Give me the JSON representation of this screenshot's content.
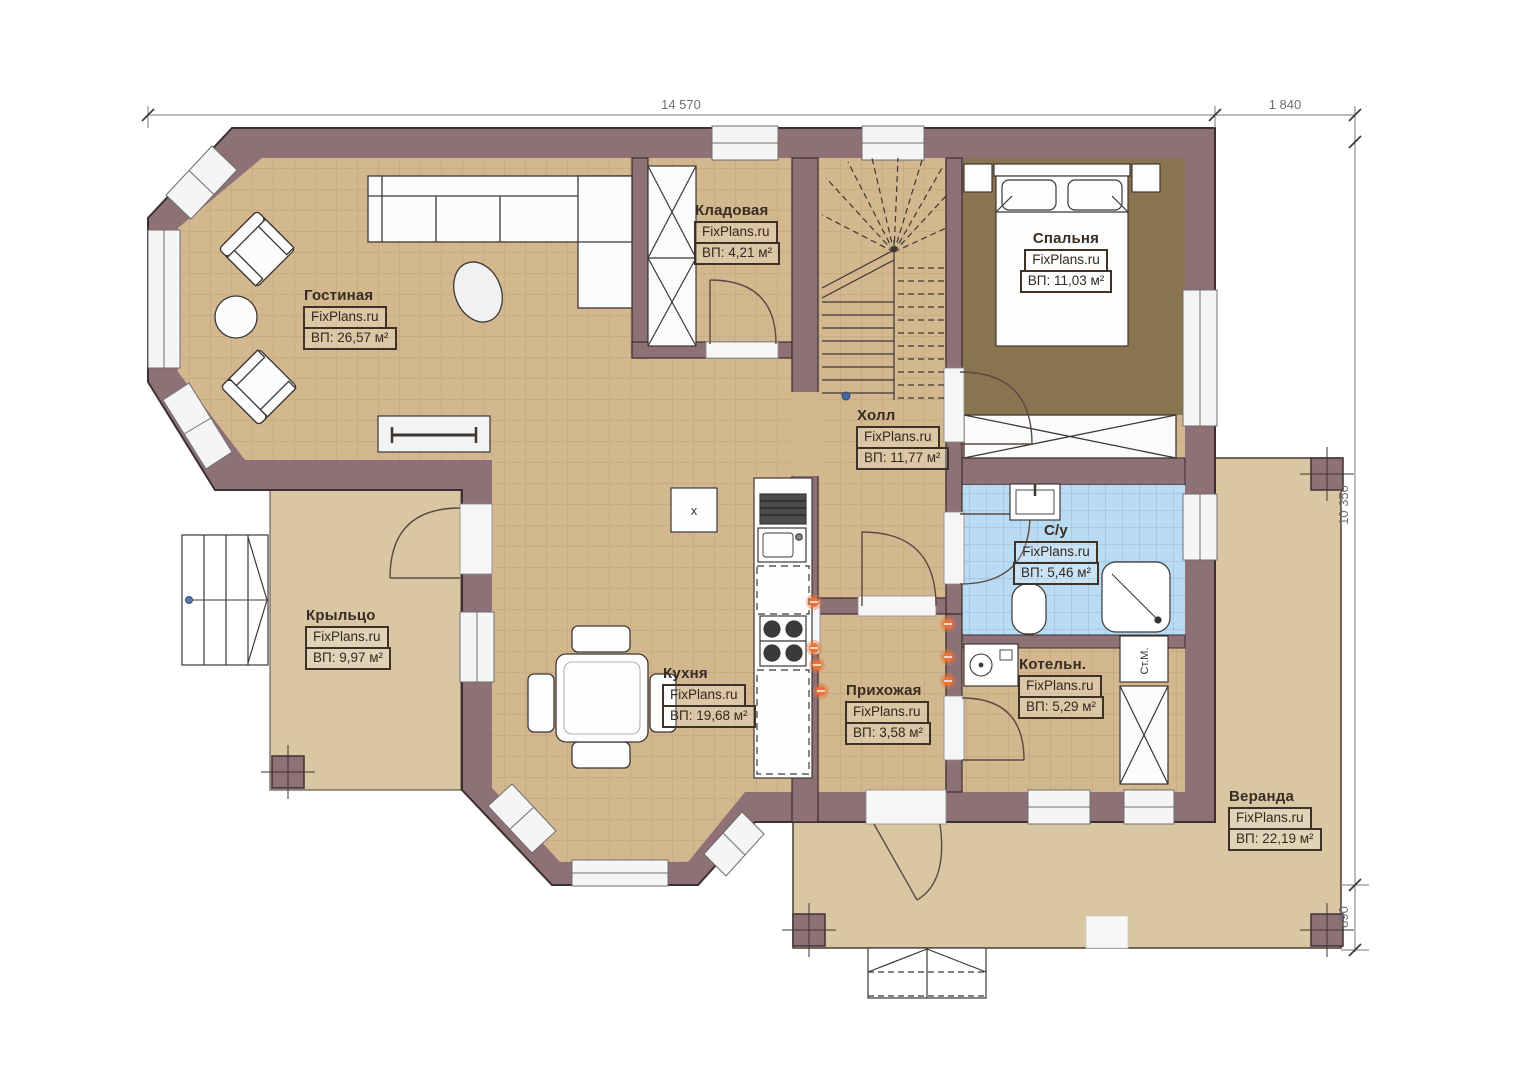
{
  "plan": {
    "brand": "FixPlans.ru",
    "dimensions": {
      "top_width": "14 570",
      "top_right_width": "1 840",
      "right_height": "10 350",
      "right_bottom_height": "890"
    },
    "rooms": [
      {
        "name": "Гостиная",
        "brand": "FixPlans.ru",
        "area": "ВП: 26,57 м²"
      },
      {
        "name": "Кладовая",
        "brand": "FixPlans.ru",
        "area": "ВП: 4,21 м²"
      },
      {
        "name": "Спальня",
        "brand": "FixPlans.ru",
        "area": "ВП: 11,03 м²"
      },
      {
        "name": "Холл",
        "brand": "FixPlans.ru",
        "area": "ВП: 11,77 м²"
      },
      {
        "name": "С/у",
        "brand": "FixPlans.ru",
        "area": "ВП: 5,46 м²"
      },
      {
        "name": "Крыльцо",
        "brand": "FixPlans.ru",
        "area": "ВП: 9,97 м²"
      },
      {
        "name": "Кухня",
        "brand": "FixPlans.ru",
        "area": "ВП: 19,68 м²"
      },
      {
        "name": "Прихожая",
        "brand": "FixPlans.ru",
        "area": "ВП: 3,58 м²"
      },
      {
        "name": "Котельн.",
        "brand": "FixPlans.ru",
        "area": "ВП: 5,29 м²"
      },
      {
        "name": "Веранда",
        "brand": "FixPlans.ru",
        "area": "ВП: 22,19 м²"
      }
    ],
    "annotations": {
      "washing_machine": "Ст.М.",
      "kitchen_unit": "x"
    },
    "colors": {
      "wall": "#8d7177",
      "floor_tile": "#d3b88f",
      "outdoor_deck": "#d9c7a4",
      "bathroom_tile": "#badbf4",
      "bedroom_floor": "#8a7350",
      "accent_orange": "#e8743a"
    }
  }
}
